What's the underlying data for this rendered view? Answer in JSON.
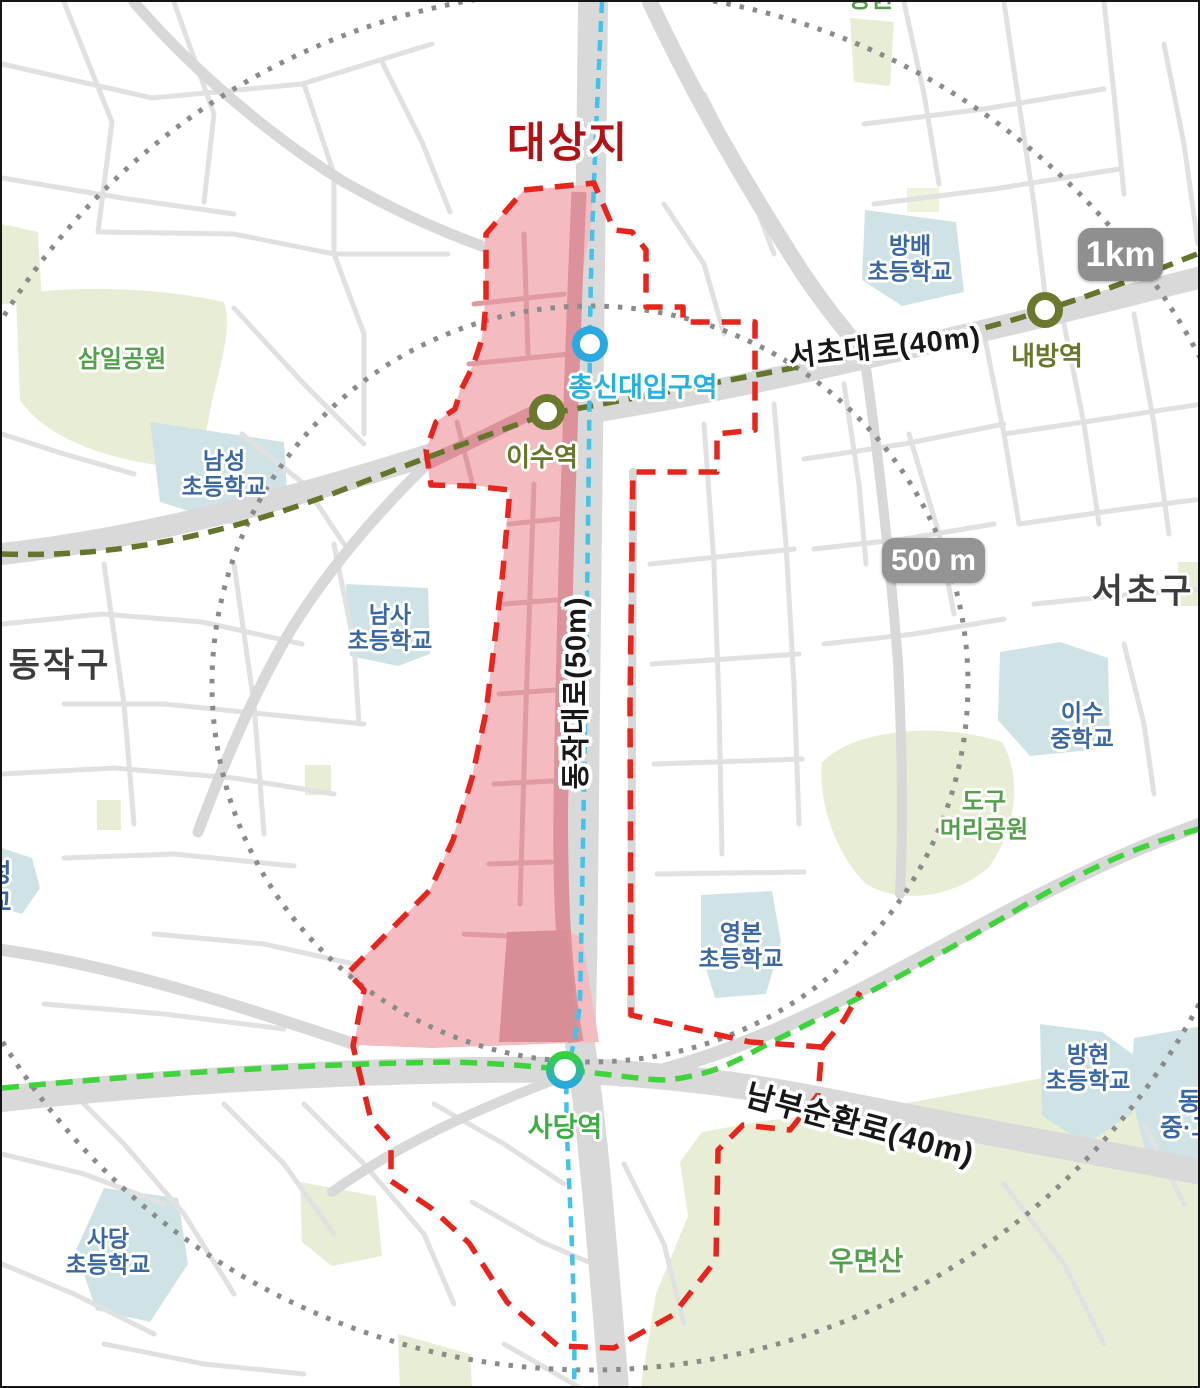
{
  "title": {
    "text": "대상지"
  },
  "districts": {
    "west": "동작구",
    "east": "서초구"
  },
  "radius_badges": {
    "inner": "500 m",
    "outer": "1km"
  },
  "roads": {
    "seocho": "서초대로(40m)",
    "dongjak": "동작대로(50m)",
    "nambu": "남부순환로(40m)"
  },
  "stations": {
    "chongshin": "총신대입구역",
    "isu": "이수역",
    "naebang": "내방역",
    "sadang": "사당역"
  },
  "schools": {
    "bangbae": {
      "line1": "방배",
      "line2": "초등학교"
    },
    "namseong": {
      "line1": "남성",
      "line2": "초등학교"
    },
    "namsa": {
      "line1": "남사",
      "line2": "초등학교"
    },
    "isu_middle": {
      "line1": "이수",
      "line2": "중학교"
    },
    "yeongbon": {
      "line1": "영본",
      "line2": "초등학교"
    },
    "banghyeon": {
      "line1": "방현",
      "line2": "초등학교"
    },
    "sadang": {
      "line1": "사당",
      "line2": "초등학교"
    },
    "dongdeok_partial": {
      "line1": "동덕",
      "line2": "중·고"
    },
    "west_partial": {
      "line1": "성",
      "line2": "교"
    }
  },
  "parks": {
    "samil": "삼일공원",
    "dogumeori": {
      "line1": "도구",
      "line2": "머리공원"
    },
    "umyeonsan": "우면산",
    "top_partial": "공원"
  },
  "colors": {
    "boundary_red": "#e8251c",
    "title_red": "#b31114",
    "site_fill": "#f4bcc0",
    "site_road": "#dd939b",
    "line4_blue": "#41c3ec",
    "line7_olive": "#64752c",
    "line2_green": "#3fd43c",
    "radius_ring_gray": "#8b8b8b",
    "school_fill": "#cfe3e6",
    "park_fill": "#e8eed6",
    "school_text": "#3a67a5",
    "park_text": "#55a04b",
    "station_cyan": "#25b2dc",
    "station_green": "#3dae44"
  }
}
